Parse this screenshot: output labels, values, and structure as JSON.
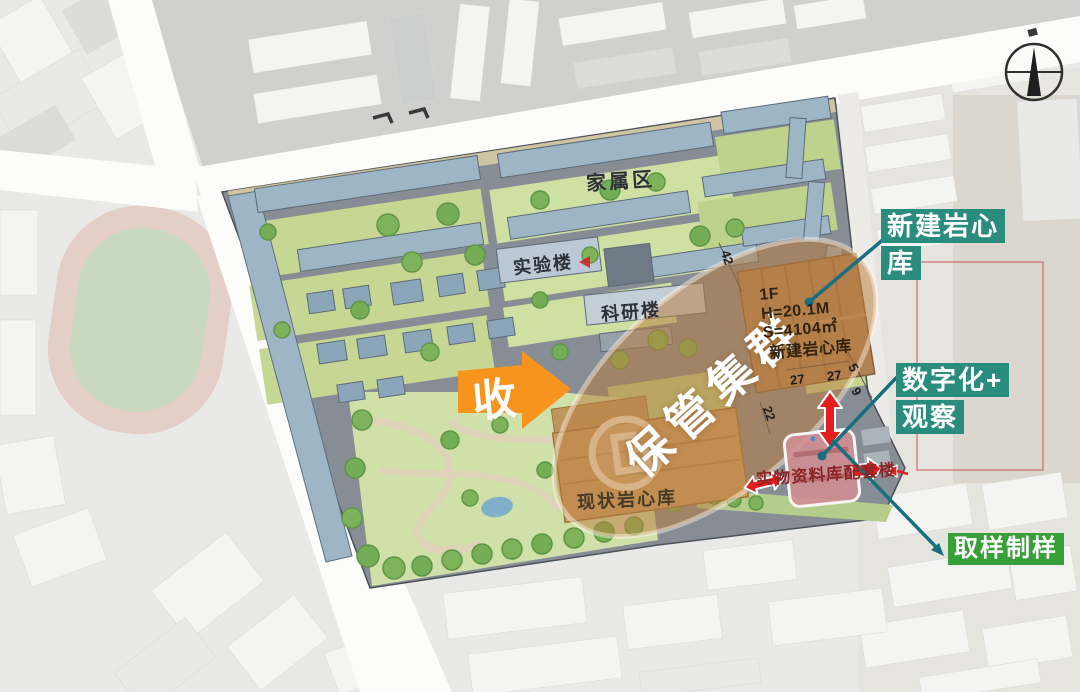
{
  "callouts": {
    "new_repo": {
      "line1": "新建岩心",
      "line2": "库"
    },
    "digitize": {
      "line1": "数字化+",
      "line2": "观察"
    },
    "sampling": {
      "label": "取样制样"
    }
  },
  "map_labels": {
    "family_area": "家属区",
    "lab_building": "实验楼",
    "research_building": "科研楼",
    "existing_repo": "现状岩心库",
    "archive_building": "实物资料库配套楼",
    "cluster": "保管集群",
    "collect_arrow": "收"
  },
  "new_building_info": {
    "floor": "1F",
    "height": "H=20.1M",
    "area": "S=4104㎡",
    "name": "新建岩心库"
  },
  "dimensions": [
    "42",
    "27",
    "27",
    "22",
    "5",
    "9"
  ],
  "colors": {
    "callout_teal": "#2a8c7d",
    "callout_green": "#38a038",
    "highlight_orange": "#f7941d",
    "annotation_red": "#e41e1e",
    "connector_teal": "#176f80",
    "ellipse_brown": "#ba7d3e"
  }
}
